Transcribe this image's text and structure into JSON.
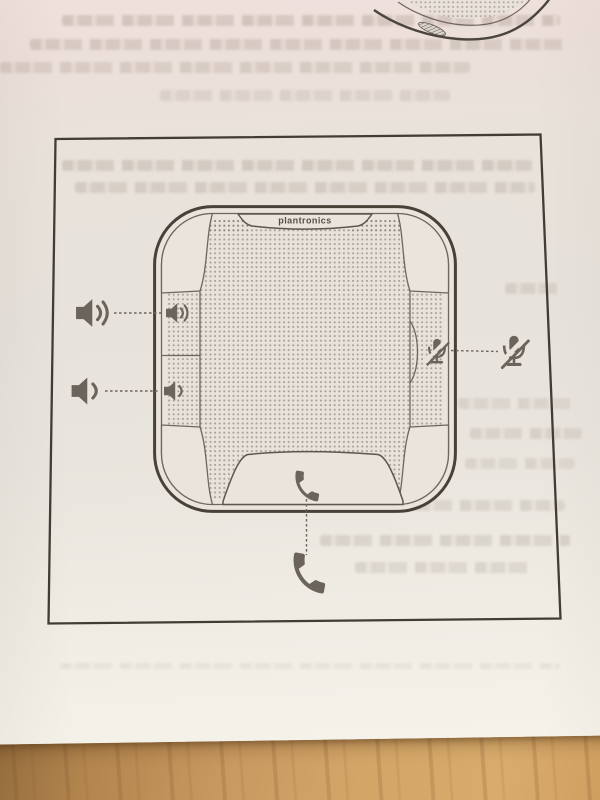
{
  "figure": {
    "brand_label": "plantronics",
    "callouts": [
      {
        "id": "volume-up",
        "icon": "speaker-volume-up-icon",
        "position": "left-top",
        "meaning": "volume up button"
      },
      {
        "id": "volume-down",
        "icon": "speaker-volume-down-icon",
        "position": "left-bottom",
        "meaning": "volume down button"
      },
      {
        "id": "mute",
        "icon": "mic-mute-icon",
        "position": "right",
        "meaning": "mute button"
      },
      {
        "id": "call",
        "icon": "phone-handset-icon",
        "position": "bottom",
        "meaning": "call button"
      }
    ],
    "colors": {
      "line_ink": "#474138",
      "icon_ink": "#6b645c",
      "paper": "#e9e3dc",
      "wood": "#c99a61"
    }
  }
}
